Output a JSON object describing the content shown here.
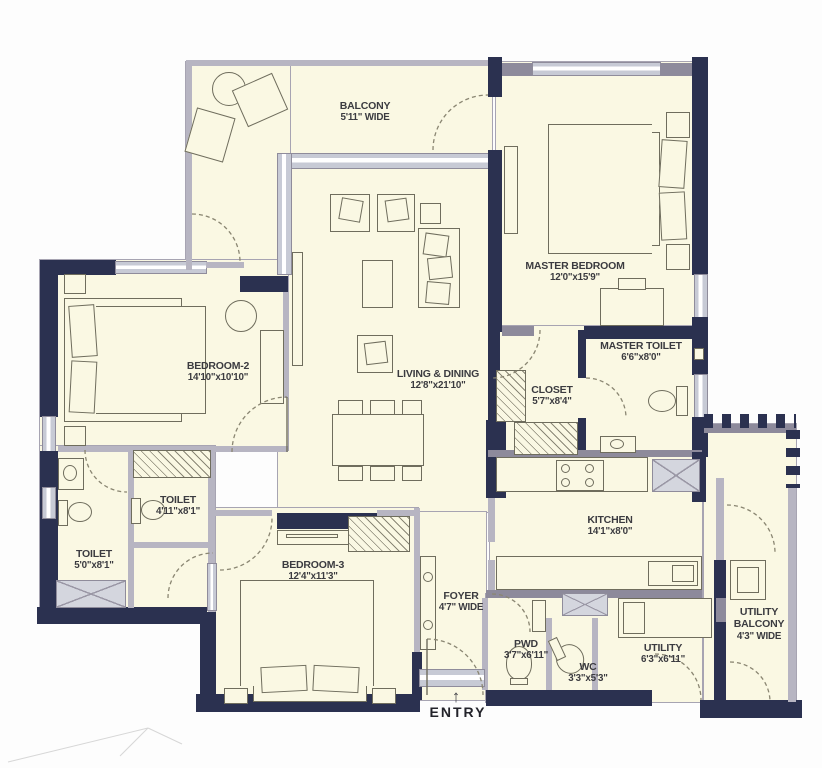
{
  "plan": {
    "title": "apartment-floor-plan",
    "entry_label": "ENTRY",
    "rooms": {
      "balcony": {
        "name": "BALCONY",
        "dims": "5'11\" WIDE"
      },
      "master_bedroom": {
        "name": "MASTER BEDROOM",
        "dims": "12'0\"x15'9\""
      },
      "bedroom2": {
        "name": "BEDROOM-2",
        "dims": "14'10\"x10'10\""
      },
      "living_dining": {
        "name": "LIVING & DINING",
        "dims": "12'8\"x21'10\""
      },
      "master_toilet": {
        "name": "MASTER TOILET",
        "dims": "6'6\"x8'0\""
      },
      "closet": {
        "name": "CLOSET",
        "dims": "5'7\"x8'4\""
      },
      "toilet_common": {
        "name": "TOILET",
        "dims": "4'11\"x8'1\""
      },
      "toilet_small": {
        "name": "TOILET",
        "dims": "5'0\"x8'1\""
      },
      "bedroom3": {
        "name": "BEDROOM-3",
        "dims": "12'4\"x11'3\""
      },
      "kitchen": {
        "name": "KITCHEN",
        "dims": "14'1\"x8'0\""
      },
      "foyer": {
        "name": "FOYER",
        "dims": "4'7\" WIDE"
      },
      "pwd": {
        "name": "PWD",
        "dims": "3'7\"x6'11\""
      },
      "wc": {
        "name": "WC",
        "dims": "3'3\"x5'3\""
      },
      "utility": {
        "name": "UTILITY",
        "dims": "6'3\"x6'11\""
      },
      "utility_balcony": {
        "name": "UTILITY BALCONY",
        "dims": "4'3\" WIDE"
      }
    },
    "colors": {
      "wall_dark": "#2B3150",
      "wall_medium": "#8D8A9B",
      "window": "#C7CAD5",
      "floor": "#FAF8E3",
      "line": "#6F6D5D"
    }
  }
}
